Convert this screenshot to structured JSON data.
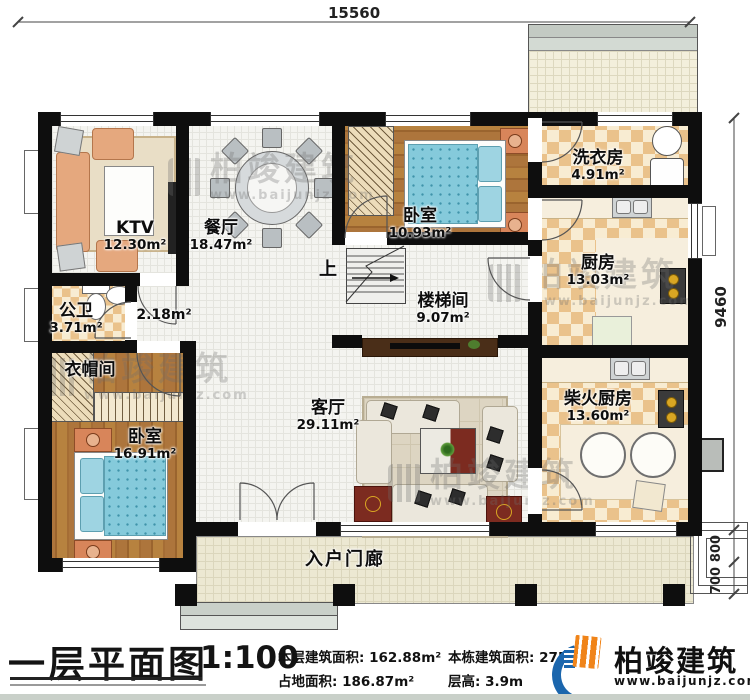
{
  "plan": {
    "dims": {
      "top": "15560",
      "right": "9460",
      "step_upper": "800",
      "step_lower": "700"
    },
    "rooms": [
      {
        "name": "KTV",
        "area": "12.30m²"
      },
      {
        "name": "餐厅",
        "area": "18.47m²"
      },
      {
        "name": "卧室",
        "area": "10.93m²"
      },
      {
        "name": "洗衣房",
        "area": "4.91m²"
      },
      {
        "name": "厨房",
        "area": "13.03m²"
      },
      {
        "name": "公卫",
        "area": "3.71m²"
      },
      {
        "name": "楼梯间",
        "area": "9.07m²"
      },
      {
        "name": "衣帽间",
        "area": ""
      },
      {
        "name": "卧室",
        "area": "16.91m²"
      },
      {
        "name": "客厅",
        "area": "29.11m²"
      },
      {
        "name": "柴火厨房",
        "area": "13.60m²"
      },
      {
        "name": "入户门廊",
        "area": ""
      }
    ],
    "hall_area": "2.18m²",
    "stairs_up": "上"
  },
  "watermark": {
    "name": "柏竣建筑",
    "url": "www.baijunjz.com"
  },
  "footer": {
    "title": "一层平面图",
    "scale": "1:100",
    "stats": [
      {
        "label": "本层建筑面积:",
        "value": "162.88m²"
      },
      {
        "label": "占地面积:",
        "value": "186.87m²"
      },
      {
        "label": "本栋建筑面积:",
        "value": "275"
      },
      {
        "label": "层高:",
        "value": "3.9m"
      }
    ],
    "brand": {
      "name": "柏竣建筑",
      "site": "www.baijunjz.com"
    }
  },
  "colors": {
    "wall": "#0e0e0e",
    "checker_tan": "#eac28b",
    "wood": "#a9713a",
    "bed_blue": "#85cadb",
    "brand_blue": "#1b66ad",
    "brand_orange": "#f08419"
  }
}
